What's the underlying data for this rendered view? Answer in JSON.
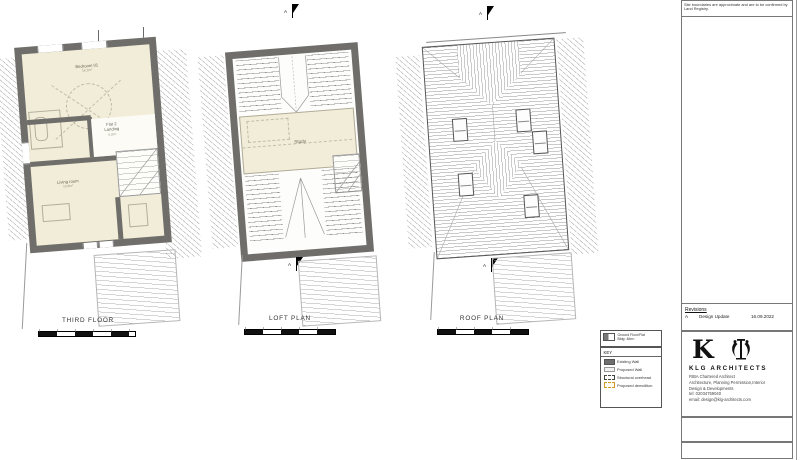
{
  "sheet": {
    "note": "Site boundaries are approximate and are to be confirmed by Land Registry."
  },
  "marker": {
    "letter": "A"
  },
  "plans": {
    "third": {
      "title": "THIRD FLOOR",
      "bedroom": "Bedroom 01",
      "bedroom_area": "16.2m²",
      "landing_line1": "Flat 2",
      "landing_line2": "Landing",
      "landing_area": "4.2m²",
      "living": "Living room",
      "living_area": "19.8m²"
    },
    "loft": {
      "title": "LOFT PLAN",
      "study": "Study"
    },
    "roof": {
      "title": "ROOF PLAN"
    }
  },
  "key": {
    "mini_line1": "Ground Floor/Flat",
    "mini_line2": "Bldg: 46m²",
    "title": "KEY",
    "items": [
      {
        "label": "Existing Wall"
      },
      {
        "label": "Proposed Wall"
      },
      {
        "label": "Structural overhead"
      },
      {
        "label": "Proposed demolition"
      }
    ]
  },
  "revisions": {
    "title": "Revisions",
    "rev": "A",
    "desc": "Design Update",
    "date": "16.09.2022"
  },
  "firm": {
    "logo_letter": "K",
    "name": "KLG ARCHITECTS",
    "line1": "RIBA Chartered Architect",
    "line2": "Architecture, Planning Permission,Interior",
    "line3": "Design & Developments",
    "tel": "tel: 02034759040",
    "email": "email: design@klg-architects.com"
  },
  "colors": {
    "existing_wall": "#6f6e6a",
    "room_fill": "#f2edd8",
    "demolition": "#d29a2b"
  }
}
